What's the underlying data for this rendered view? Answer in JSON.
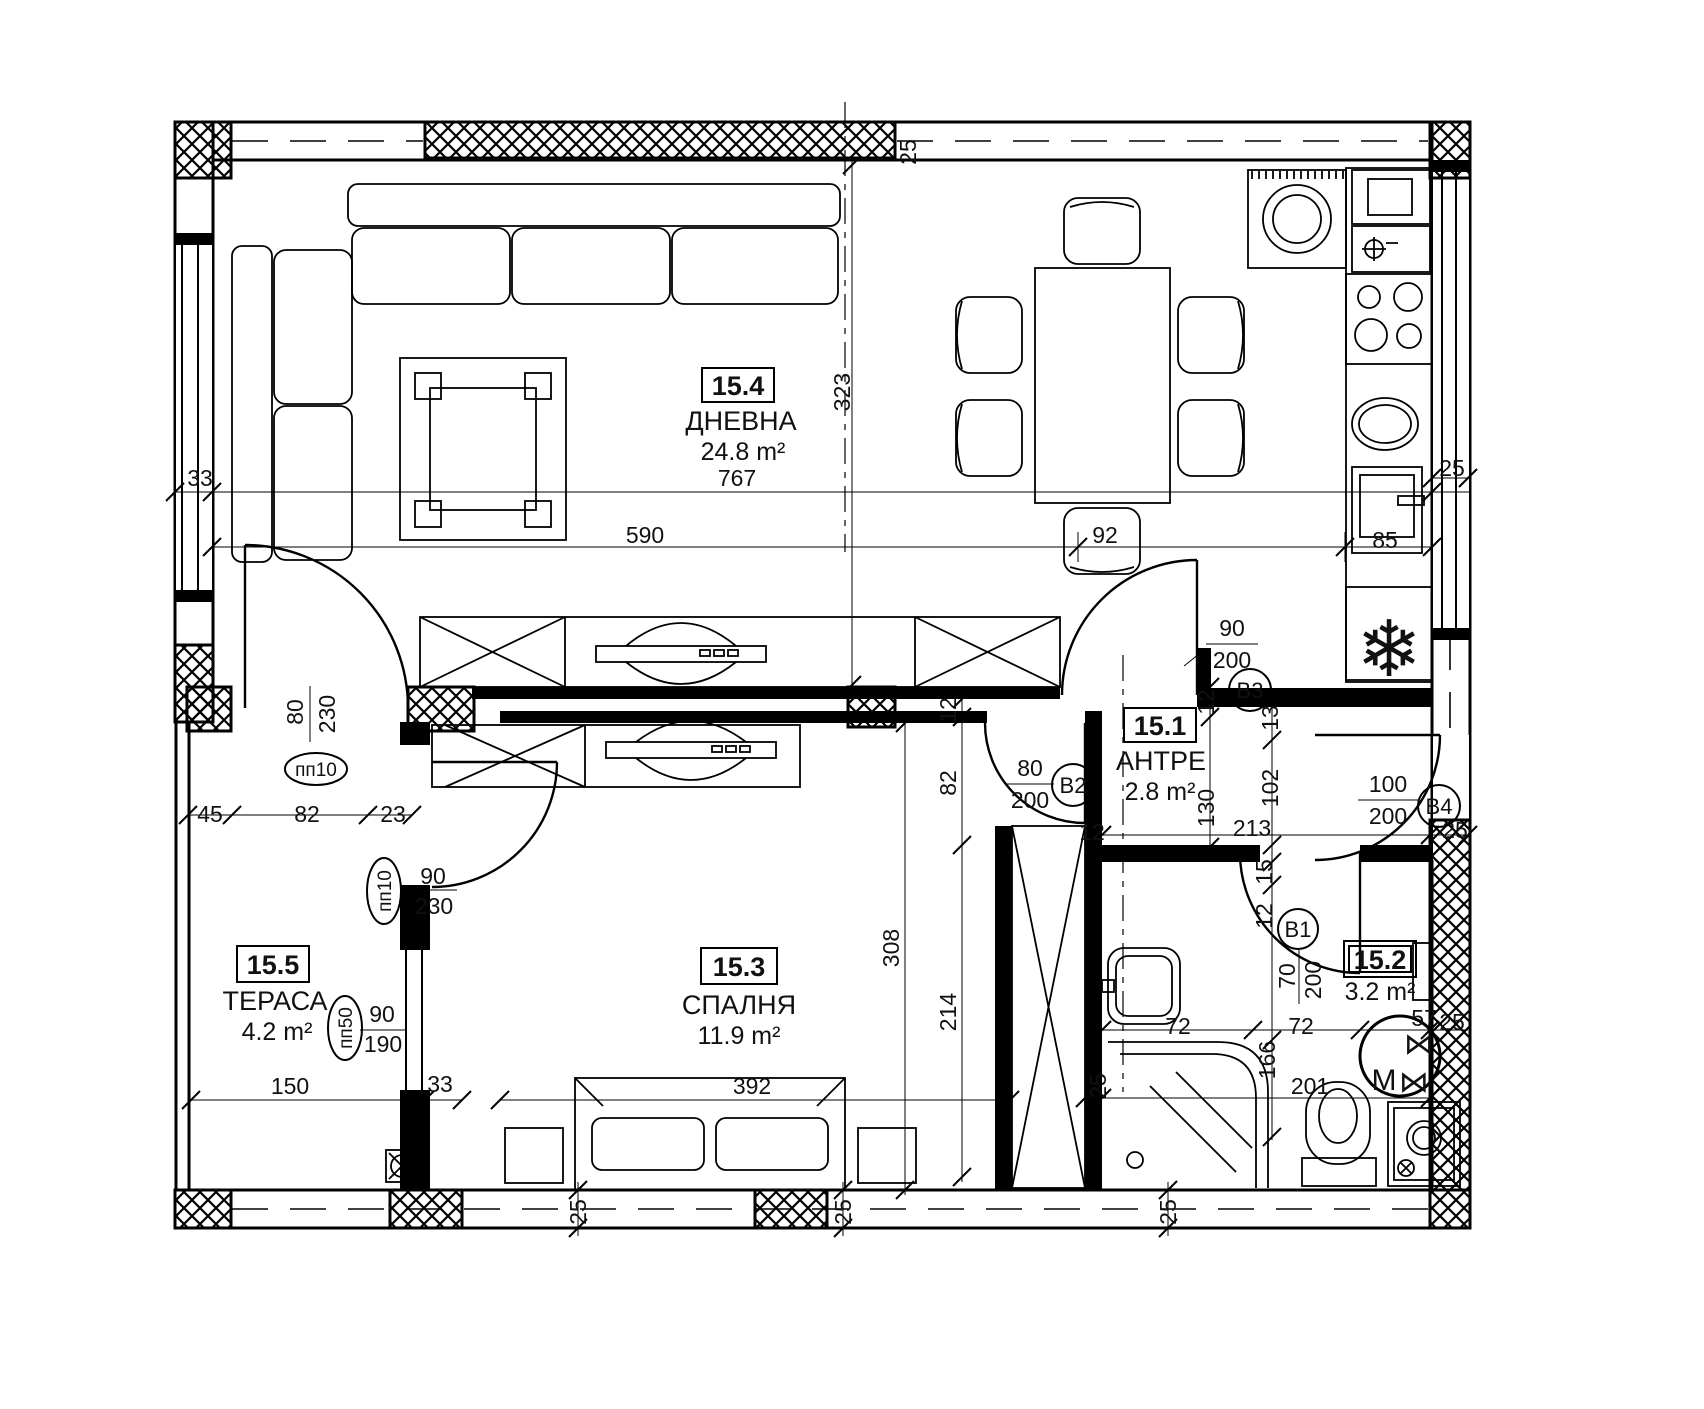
{
  "rooms": [
    {
      "number": "15.4",
      "name": "ДНЕВНА",
      "area": "24.8 m²"
    },
    {
      "number": "15.1",
      "name": "АНТРЕ",
      "area": "2.8 m²"
    },
    {
      "number": "15.3",
      "name": "СПАЛНЯ",
      "area": "11.9 m²"
    },
    {
      "number": "15.5",
      "name": "ТЕРАСА",
      "area": "4.2 m²"
    },
    {
      "number": "15.2",
      "name": "",
      "area": "3.2 m²"
    }
  ],
  "doors": [
    {
      "id": "B1",
      "width": "70",
      "height": "200"
    },
    {
      "id": "B2",
      "width": "80",
      "height": "200"
    },
    {
      "id": "B3",
      "width": "90",
      "height": "200"
    },
    {
      "id": "B4",
      "width": "100",
      "height": "200"
    }
  ],
  "windows": [
    {
      "id": "пп10",
      "width": "80",
      "height": "230"
    },
    {
      "id": "пп10",
      "width": "90",
      "height": "230"
    },
    {
      "id": "пп50",
      "width": "90",
      "height": "190"
    }
  ],
  "dims": [
    "767",
    "590",
    "92",
    "85",
    "323",
    "25",
    "33",
    "25",
    "45",
    "82",
    "23",
    "12",
    "82",
    "214",
    "308",
    "12",
    "130",
    "13",
    "102",
    "213",
    "25",
    "12",
    "15",
    "12",
    "72",
    "72",
    "166",
    "201",
    "57",
    "25",
    "25",
    "150",
    "33",
    "392",
    "25",
    "25",
    "25"
  ],
  "icons": {
    "fridge_snowflake": "❄",
    "boiler_coil": "⋈",
    "boiler_motor": "M"
  }
}
